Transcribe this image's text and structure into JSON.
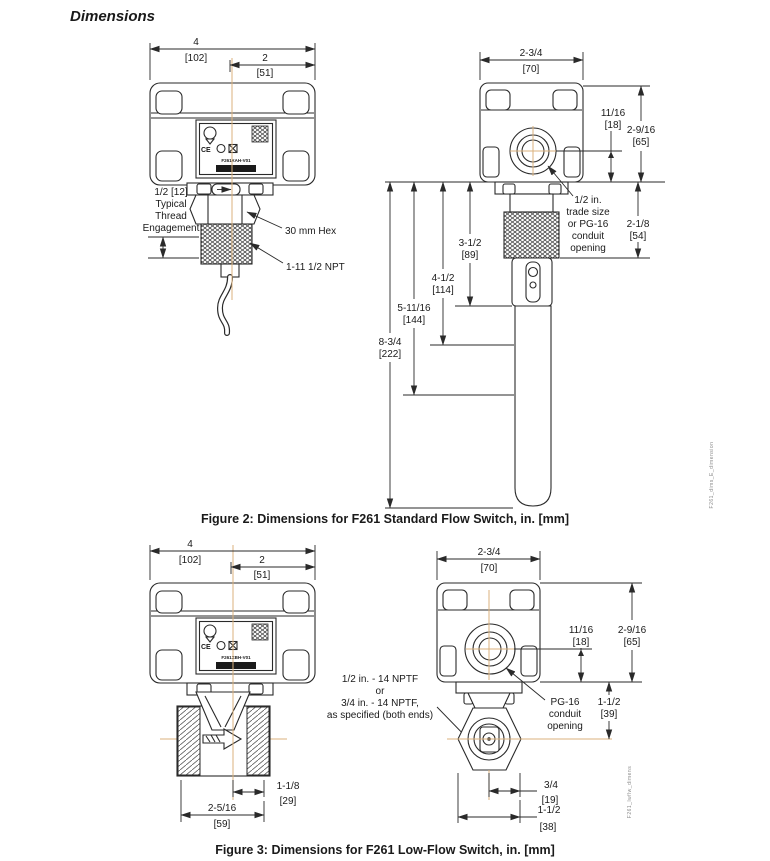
{
  "title": "Dimensions",
  "colors": {
    "line": "#2a2a2a",
    "centerline": "#dbb27c",
    "microtext": "#8a8a8a"
  },
  "fig2": {
    "caption": "Figure 2: Dimensions for F261 Standard Flow Switch, in. [mm]",
    "side_note": "F261_dims_E_dimension",
    "left": {
      "nameplate": {
        "model": "F261XAH-V01",
        "ce": "CE"
      },
      "w4_in": "4",
      "w4_mm": "[102]",
      "w2_in": "2",
      "w2_mm": "[51]",
      "engagement_l1": "1/2 [12]",
      "engagement_l2": "Typical",
      "engagement_l3": "Thread",
      "engagement_l4": "Engagement",
      "hex_label": "30 mm Hex",
      "npt_label": "1-11 1/2 NPT"
    },
    "right": {
      "w_in": "2-3/4",
      "w_mm": "[70]",
      "d1_in": "11/16",
      "d1_mm": "[18]",
      "d2_in": "2-9/16",
      "d2_mm": "[65]",
      "d3_in": "2-1/8",
      "d3_mm": "[54]",
      "conduit_l1": "1/2 in.",
      "conduit_l2": "trade size",
      "conduit_l3": "or PG-16",
      "conduit_l4": "conduit",
      "conduit_l5": "opening",
      "len1_in": "3-1/2",
      "len1_mm": "[89]",
      "len2_in": "4-1/2",
      "len2_mm": "[114]",
      "len3_in": "5-11/16",
      "len3_mm": "[144]",
      "len4_in": "8-3/4",
      "len4_mm": "[222]"
    }
  },
  "fig3": {
    "caption": "Figure 3: Dimensions for F261 Low-Flow Switch, in. [mm]",
    "side_note": "F261_lwflw_dimens",
    "left": {
      "nameplate": {
        "model": "F261XBH-V01",
        "ce": "CE"
      },
      "w4_in": "4",
      "w4_mm": "[102]",
      "w2_in": "2",
      "w2_mm": "[51]",
      "port_l1": "1/2 in. - 14 NPTF",
      "port_l2": "or",
      "port_l3": "3/4 in. - 14 NPTF,",
      "port_l4": "as specified (both ends)",
      "d1_in": "1-1/8",
      "d1_mm": "[29]",
      "d2_in": "2-5/16",
      "d2_mm": "[59]"
    },
    "right": {
      "w_in": "2-3/4",
      "w_mm": "[70]",
      "d1_in": "11/16",
      "d1_mm": "[18]",
      "d2_in": "2-9/16",
      "d2_mm": "[65]",
      "d3_in": "1-1/2",
      "d3_mm": "[39]",
      "conduit_l1": "PG-16",
      "conduit_l2": "conduit",
      "conduit_l3": "opening",
      "d4_in": "3/4",
      "d4_mm": "[19]",
      "d5_in": "1-1/2",
      "d5_mm": "[38]"
    }
  }
}
